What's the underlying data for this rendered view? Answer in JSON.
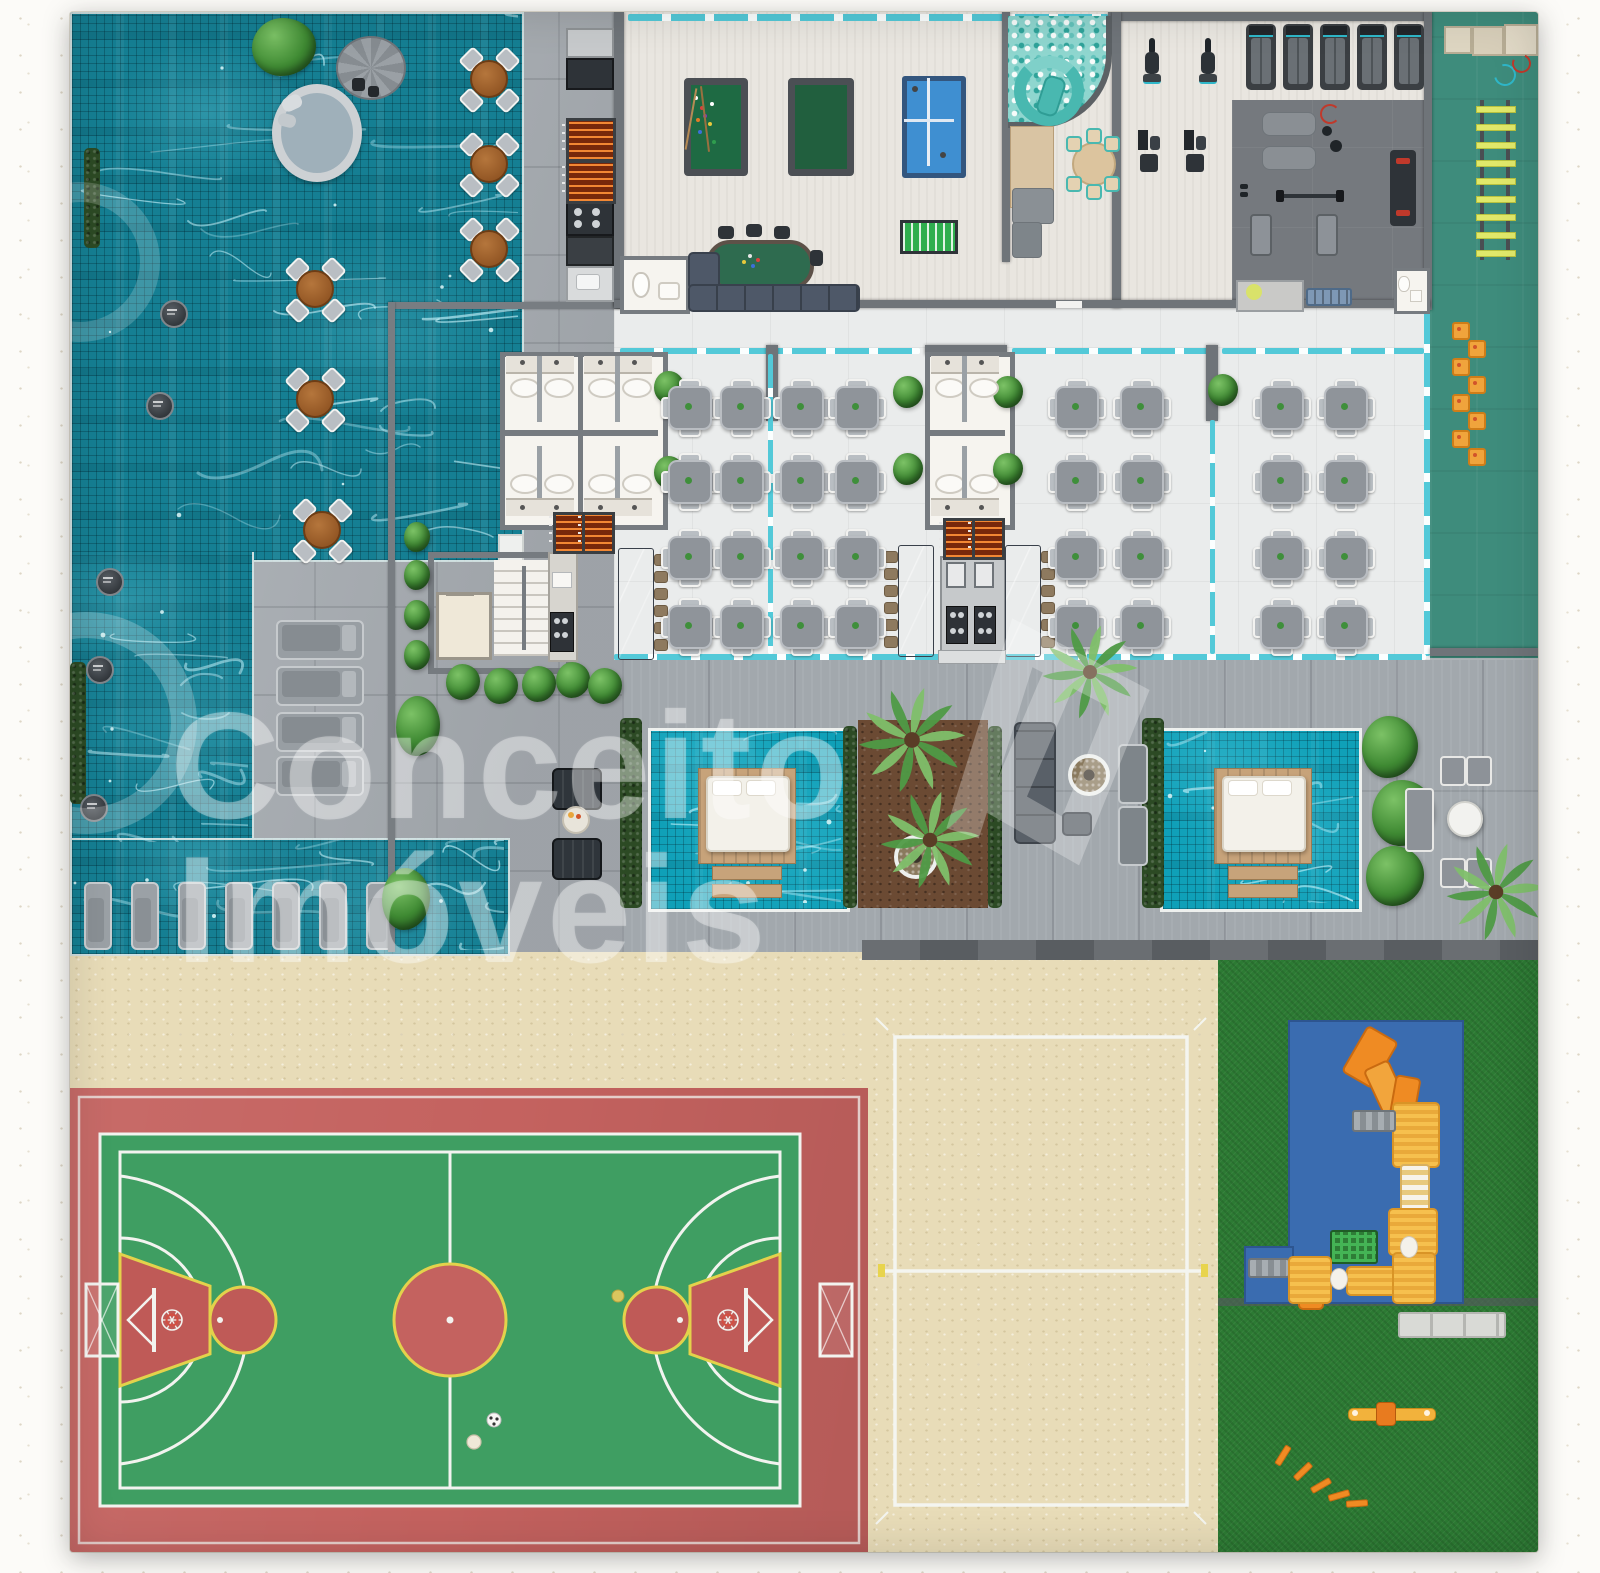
{
  "watermark": {
    "line1": "Conceito",
    "line2": "Imóveis"
  },
  "palette": {
    "frame": "#f1eee6",
    "deck_stone": "#a9aeb3",
    "deck_plank": "#a2a8ad",
    "pool_water": "#157f93",
    "cabana_water": "#0fa0b8",
    "indoor_floor": "#e9e6e0",
    "dining_floor": "#eaecec",
    "gym_dark_floor": "#75797e",
    "gym_green": "#3e8c7c",
    "wall": "#6f7479",
    "glass": "#53c9d8",
    "court_red": "#c4625f",
    "court_green": "#3f9e62",
    "court_line_white": "#f2f3ef",
    "court_line_yellow": "#e3d24b",
    "sand": "#e8dcb8",
    "grass": "#2c7a33",
    "play_mat_blue": "#3a6cb0",
    "play_yellow": "#f6bb4a",
    "play_orange": "#ef8b23",
    "hedge_green": "#2c4a24",
    "wood": "#c7a37a",
    "watermark": "rgba(255,255,255,0.34)"
  },
  "amenities": {
    "lap_pool": 1,
    "in_pool_loungers": 7,
    "deck_sun_loungers": 4,
    "deck_round_tables": 6,
    "outdoor_kitchen_grills": 2,
    "billiards_tables": 2,
    "table_tennis_tables": 1,
    "foosball_tables": 1,
    "card_tables": 1,
    "kids_ball_pit": 1,
    "treadmills": 5,
    "exercise_bikes": 2,
    "strength_stations": 2,
    "party_hall_dining_tables": 32,
    "bbq_grill_stations": 3,
    "counter_tables": 3,
    "cabana_plunge_pools": 2,
    "daybeds": 2,
    "fire_pits": 2,
    "multisport_court": 1,
    "beach_volleyball_court": 1,
    "playground": 1,
    "seesaw": 1,
    "agility_ladder": 1,
    "plyo_boxes": 3
  }
}
